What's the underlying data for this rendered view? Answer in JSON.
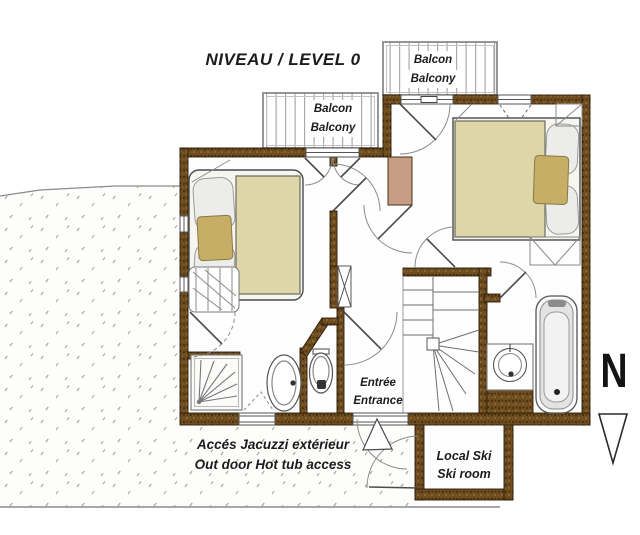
{
  "title": "NIVEAU / LEVEL 0",
  "balconies": {
    "left": {
      "label_fr": "Balcon",
      "label_en": "Balcony"
    },
    "right": {
      "label_fr": "Balcon",
      "label_en": "Balcony"
    }
  },
  "entrance": {
    "label_fr": "Entrée",
    "label_en": "Entrance"
  },
  "jacuzzi_access": {
    "label_fr": "Accés Jacuzzi extérieur",
    "label_en": "Out door Hot tub access"
  },
  "ski_room": {
    "label_fr": "Local Ski",
    "label_en": "Ski room"
  },
  "compass": {
    "label": "N"
  },
  "colors": {
    "wall_brown": "#6a4a1e",
    "bed_duvet": "#ded6a9",
    "cushion_gold": "#c6ae67",
    "block_tan": "#c79d85",
    "deck_stripe": "#ababab",
    "terrain_dot": "#8f8f85"
  }
}
